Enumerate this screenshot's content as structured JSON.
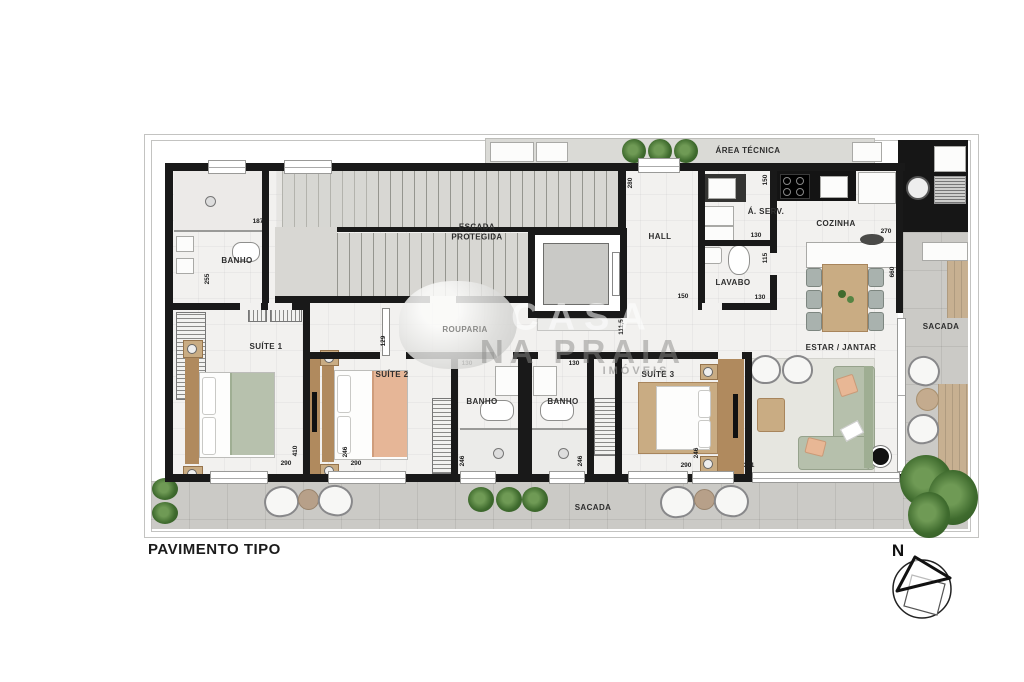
{
  "title": "PAVIMENTO TIPO",
  "compass": {
    "north": "N"
  },
  "watermark": {
    "top": "CASA",
    "main": "NA PRAIA",
    "sub": "IMÓVEIS"
  },
  "rooms": {
    "banho_suite1": "BANHO",
    "escada": "ESCADA\nPROTEGIDA",
    "hall": "HALL",
    "area_servico": "Á. SERV.",
    "lavabo": "LAVABO",
    "cozinha": "COZINHA",
    "area_tecnica": "ÁREA TÉCNICA",
    "sacada_lateral": "SACADA",
    "estar_jantar": "ESTAR / JANTAR",
    "suite1": "SUÍTE 1",
    "suite2": "SUÍTE 2",
    "suite3": "SUÍTE 3",
    "banho_suite2": "BANHO",
    "banho_suite3": "BANHO",
    "sacada_frontal": "SACADA",
    "rouparia": "ROUPARIA"
  },
  "dimensions": {
    "banho1_width": "187",
    "banho1_depth": "255",
    "hall_width": "280",
    "hall_door": "150",
    "hall_depth": "111,5",
    "lavabo_top": "130",
    "lavabo_side": "115",
    "lavabo_bottom": "130",
    "cozinha_top": "150",
    "cozinha_opening": "270",
    "estar_width": "660",
    "corredor": "129",
    "suite1_depth": "410",
    "suite1_width": "290",
    "suite2_depth": "246",
    "suite2_width": "290",
    "banho2_width": "130",
    "banho2_depth": "246",
    "banho3_width": "130",
    "banho3_depth": "246",
    "suite3_width": "290",
    "suite3_depth": "246",
    "estar_door": "371"
  }
}
